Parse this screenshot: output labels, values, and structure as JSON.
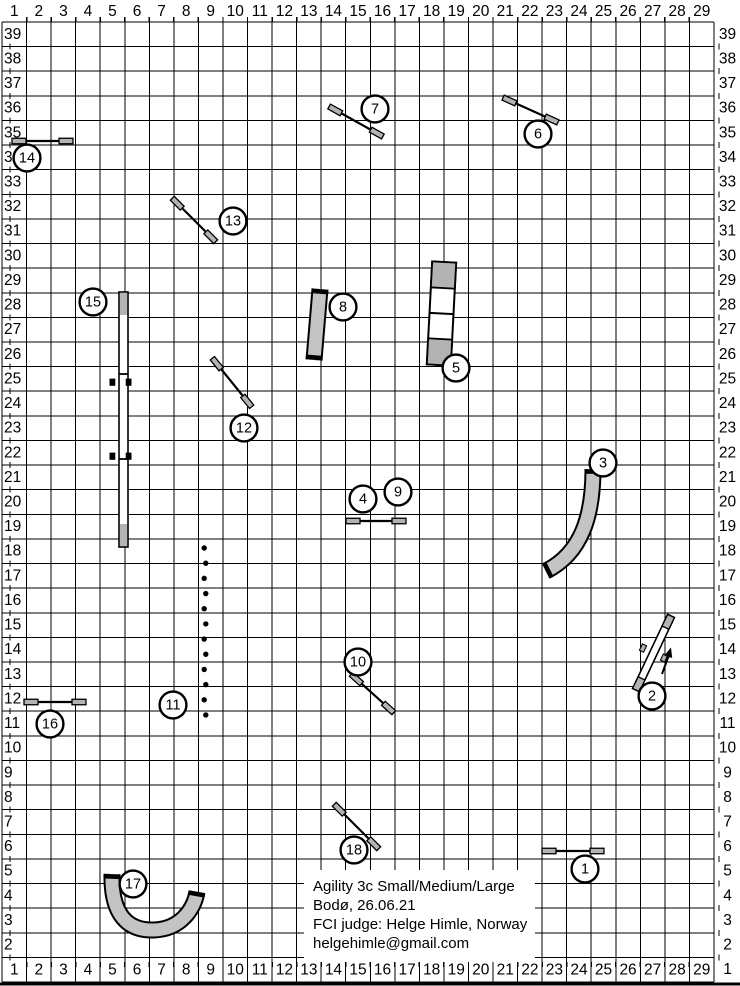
{
  "info_box": {
    "lines": [
      "Agility 3c Small/Medium/Large",
      "Bodø, 26.06.21",
      "FCI judge: Helge Himle, Norway",
      "helgehimle@gmail.com"
    ]
  },
  "ruler": {
    "col_labels": [
      "1",
      "2",
      "3",
      "4",
      "5",
      "6",
      "7",
      "8",
      "9",
      "10",
      "11",
      "12",
      "13",
      "14",
      "15",
      "16",
      "17",
      "18",
      "19",
      "20",
      "21",
      "22",
      "23",
      "24",
      "25",
      "26",
      "27",
      "28",
      "29"
    ],
    "row_labels_left": [
      "39",
      "38",
      "37",
      "36",
      "35",
      "34",
      "33",
      "32",
      "31",
      "30",
      "29",
      "28",
      "27",
      "26",
      "25",
      "24",
      "23",
      "22",
      "21",
      "20",
      "19",
      "18",
      "17",
      "16",
      "15",
      "14",
      "13",
      "12",
      "11",
      "10",
      "9",
      "8",
      "7",
      "6",
      "5",
      "4",
      "3",
      "2"
    ],
    "row_labels_right": [
      "39",
      "38",
      "37",
      "36",
      "35",
      "34",
      "33",
      "32",
      "31",
      "30",
      "29",
      "28",
      "27",
      "26",
      "25",
      "24",
      "23",
      "22",
      "21",
      "20",
      "19",
      "18",
      "17",
      "16",
      "15",
      "14",
      "13",
      "12",
      "11",
      "10",
      "9",
      "8",
      "7",
      "6",
      "5",
      "4",
      "3",
      "2",
      "1"
    ]
  },
  "colors": {
    "line": "#000000",
    "tunnel_gray": "#c4c4c4",
    "cap_gray": "#b3b3b3",
    "circle_fill": "#ffffff",
    "text": "#000000"
  },
  "course": {
    "jumps": [
      {
        "num": "14",
        "x1": 13,
        "y1": 141,
        "x2": 72,
        "y2": 141
      },
      {
        "num": "16",
        "x1": 25,
        "y1": 702,
        "x2": 85,
        "y2": 702
      },
      {
        "num": "4-9",
        "x1": 347,
        "y1": 521,
        "x2": 405,
        "y2": 521
      },
      {
        "num": "1",
        "x1": 543,
        "y1": 851,
        "x2": 603,
        "y2": 851
      },
      {
        "num": "7",
        "x1": 330,
        "y1": 107,
        "x2": 382,
        "y2": 136
      },
      {
        "num": "6",
        "x1": 504,
        "y1": 98,
        "x2": 557,
        "y2": 122
      },
      {
        "num": "13",
        "x1": 173,
        "y1": 199,
        "x2": 215,
        "y2": 241
      },
      {
        "num": "12",
        "x1": 213,
        "y1": 359,
        "x2": 251,
        "y2": 406
      },
      {
        "num": "10",
        "x1": 352,
        "y1": 675,
        "x2": 393,
        "y2": 712
      },
      {
        "num": "18",
        "x1": 335,
        "y1": 805,
        "x2": 378,
        "y2": 848
      }
    ],
    "tunnels": [
      {
        "num": "8",
        "path": "M 320 289 L 314 360",
        "caps": [
          {
            "x": 320,
            "y": 291.5,
            "deg": 94.8
          },
          {
            "x": 314.2,
            "y": 357.5,
            "deg": 94.8
          }
        ]
      },
      {
        "num": "3",
        "path": "M 593 469 C 593 515 582 553 546 571",
        "caps": [
          {
            "x": 593,
            "y": 471.5,
            "deg": 90
          },
          {
            "x": 547.8,
            "y": 570.2,
            "deg": 153.4
          }
        ]
      },
      {
        "num": "17",
        "path": "M 112 874 C 111 915 128 931 154 930 C 181 929 194 909 197 892",
        "caps": [
          {
            "x": 112,
            "y": 876.5,
            "deg": 92
          },
          {
            "x": 196.6,
            "y": 893.9,
            "deg": -80
          }
        ]
      }
    ],
    "dog_walk": {
      "num": "15",
      "plank": {
        "x": 119,
        "y": 292,
        "w": 9,
        "h": 255
      },
      "contact_h": 22,
      "dividers": [
        374,
        459
      ],
      "ticks": [
        {
          "x": 112.4,
          "y": 378.6
        },
        {
          "x": 128.6,
          "y": 378.6
        },
        {
          "x": 112.4,
          "y": 452.6
        },
        {
          "x": 128.6,
          "y": 452.6
        }
      ],
      "tick_w": 5.8,
      "tick_h": 7.2
    },
    "seesaw": {
      "num": "2",
      "cx": 653.5,
      "cy": 653,
      "len": 82,
      "w": 7.5,
      "deg": -64.7,
      "cap_len": 13,
      "tick_offset": 9.3,
      "tick_w": 7,
      "tick_h": 4.6
    },
    "a_frame": {
      "num": "5",
      "cx": 441.5,
      "cy": 313.5,
      "w": 24,
      "h": 103,
      "deg": 3,
      "contact_h": 26
    },
    "weave_poles": {
      "num": "11",
      "x": 205,
      "y0": 548,
      "spacing": 15.18,
      "count": 12,
      "r": 2.7
    },
    "direction_arrow": {
      "shaft": [
        662,
        674,
        668.4,
        656.5
      ],
      "head": "671,647.5 672.2,658 664.2,655.8"
    },
    "numbers": [
      {
        "n": "1",
        "x": 585,
        "y": 869
      },
      {
        "n": "2",
        "x": 652,
        "y": 696
      },
      {
        "n": "3",
        "x": 603,
        "y": 463
      },
      {
        "n": "4",
        "x": 363,
        "y": 499
      },
      {
        "n": "5",
        "x": 456,
        "y": 368
      },
      {
        "n": "6",
        "x": 538,
        "y": 134
      },
      {
        "n": "7",
        "x": 375,
        "y": 109
      },
      {
        "n": "8",
        "x": 343,
        "y": 307
      },
      {
        "n": "9",
        "x": 398,
        "y": 492
      },
      {
        "n": "10",
        "x": 358,
        "y": 662
      },
      {
        "n": "11",
        "x": 173,
        "y": 705
      },
      {
        "n": "12",
        "x": 244,
        "y": 428
      },
      {
        "n": "13",
        "x": 233,
        "y": 221
      },
      {
        "n": "14",
        "x": 27,
        "y": 158
      },
      {
        "n": "15",
        "x": 93,
        "y": 302
      },
      {
        "n": "16",
        "x": 50,
        "y": 724
      },
      {
        "n": "17",
        "x": 133,
        "y": 884
      },
      {
        "n": "18",
        "x": 354,
        "y": 850
      }
    ]
  }
}
